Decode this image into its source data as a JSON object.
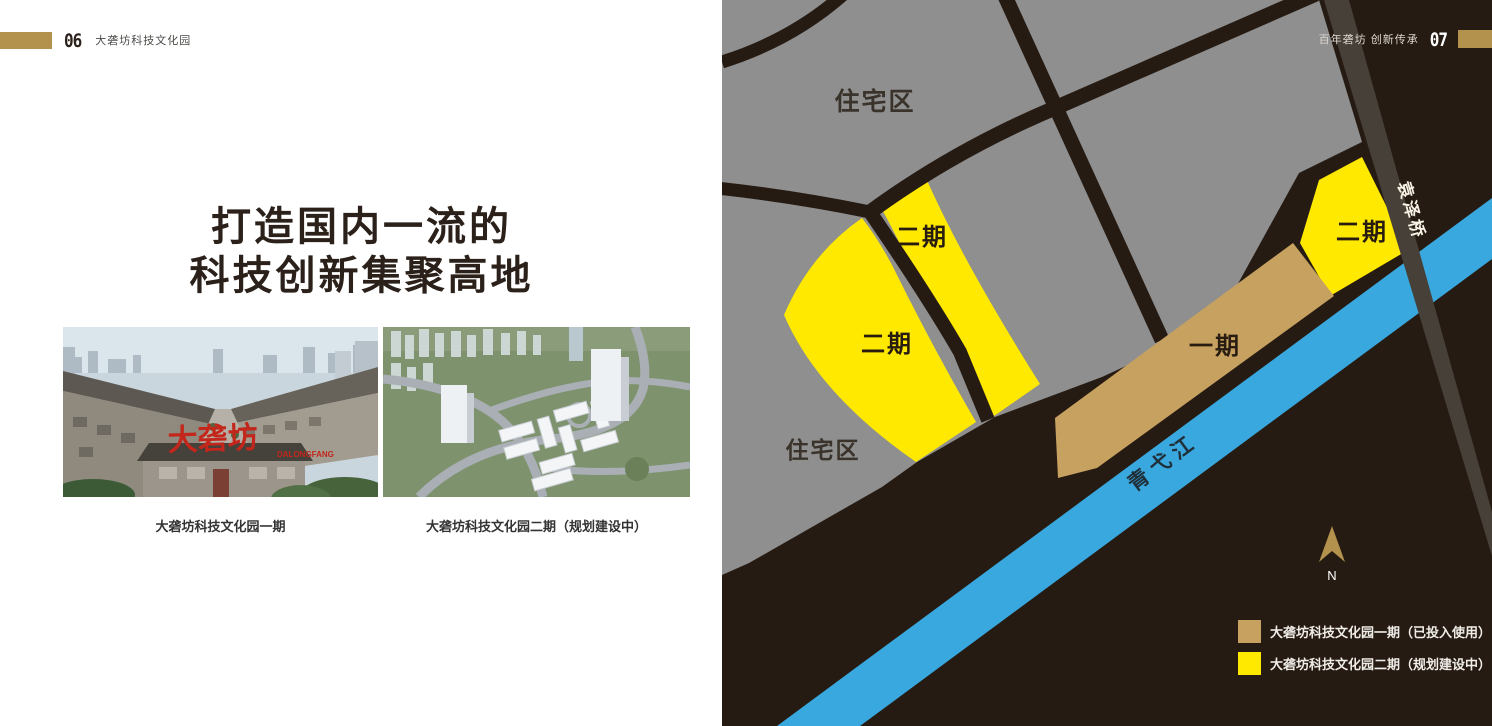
{
  "left_page": {
    "header": {
      "page_number": "06",
      "doc_title": "大砻坊科技文化园"
    },
    "headline": {
      "line1": "打造国内一流的",
      "line2": "科技创新集聚高地"
    },
    "photos": [
      {
        "caption": "大砻坊科技文化园一期",
        "sign_text": "大砻坊",
        "sign_subtext": "DALONGFANG"
      },
      {
        "caption": "大砻坊科技文化园二期（规划建设中）"
      }
    ]
  },
  "right_page": {
    "header": {
      "doc_title": "百年砻坊 创新传承",
      "page_number": "07"
    },
    "map": {
      "labels": {
        "residential_top": "住宅区",
        "residential_bottom": "住宅区",
        "phase2_left_upper": "二期",
        "phase2_left_lower": "二期",
        "phase2_right": "二期",
        "phase1": "一期",
        "river": "青弋江",
        "bridge": "袁泽桥",
        "compass_north": "N"
      },
      "legend": [
        {
          "label": "大砻坊科技文化园一期（已投入使用）",
          "color": "#C7A160"
        },
        {
          "label": "大砻坊科技文化园二期（规划建设中）",
          "color": "#FFE900"
        }
      ],
      "colors": {
        "background": "#261B13",
        "residential_gray": "#8F8F8F",
        "phase1_tan": "#C7A160",
        "phase2_yellow": "#FFE900",
        "river_blue": "#39A8DE",
        "bridge_gray": "#474038",
        "accent_gold": "#B3924E"
      }
    }
  }
}
